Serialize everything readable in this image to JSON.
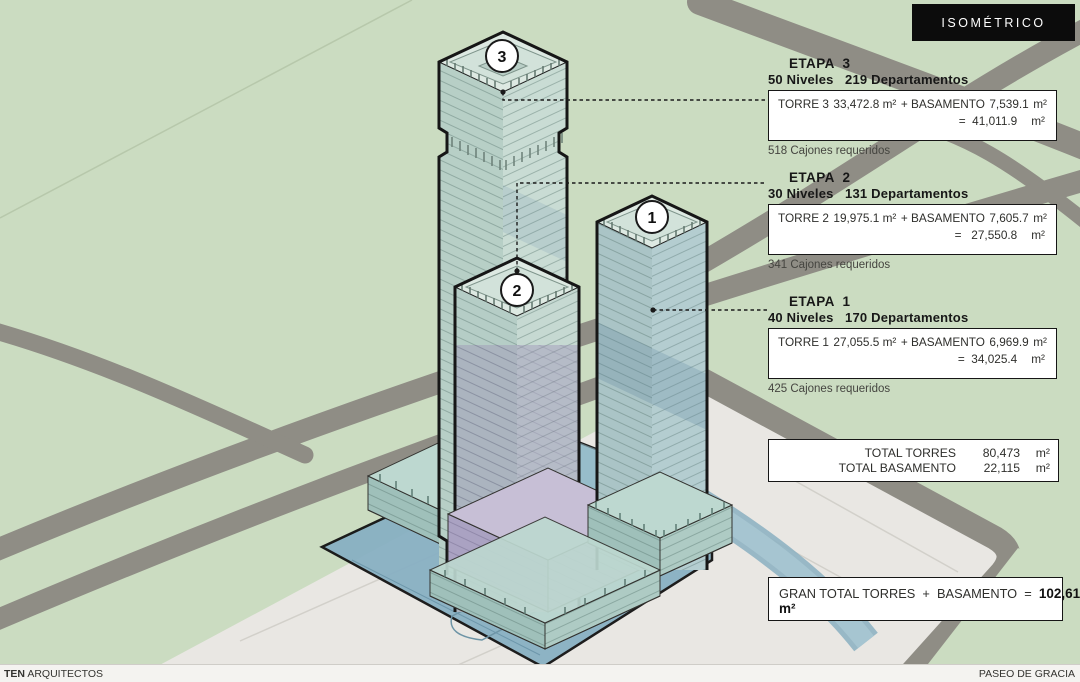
{
  "header": {
    "title": "ISOMÉTRICO"
  },
  "stages": [
    {
      "title": "ETAPA  3",
      "subtitle": "50 Niveles   219 Departamentos",
      "torre": "TORRE 3",
      "torre_area": "33,472.8 m²",
      "plus": "+ BASAMENTO",
      "bas_area": "7,539.1",
      "bas_unit": "m²",
      "total": "=  41,011.9",
      "total_unit": "m²",
      "note": "518 Cajones requeridos",
      "marker": "3"
    },
    {
      "title": "ETAPA  2",
      "subtitle": "30 Niveles   131 Departamentos",
      "torre": "TORRE 2",
      "torre_area": "19,975.1 m²",
      "plus": "+ BASAMENTO",
      "bas_area": "7,605.7",
      "bas_unit": "m²",
      "total": "=   27,550.8",
      "total_unit": "m²",
      "note": "341 Cajones requeridos",
      "marker": "2"
    },
    {
      "title": "ETAPA  1",
      "subtitle": "40 Niveles   170 Departamentos",
      "torre": "TORRE 1",
      "torre_area": "27,055.5 m²",
      "plus": "+ BASAMENTO",
      "bas_area": "6,969.9",
      "bas_unit": "m²",
      "total": "=  34,025.4",
      "total_unit": "m²",
      "note": "425 Cajones requeridos",
      "marker": "1"
    }
  ],
  "totals": {
    "rows": [
      {
        "label": "TOTAL TORRES",
        "value": "80,473",
        "unit": "m²"
      },
      {
        "label": "TOTAL BASAMENTO",
        "value": "22,115",
        "unit": "m²"
      }
    ]
  },
  "grand_total": {
    "label": "GRAN TOTAL TORRES  +  BASAMENTO  =  ",
    "value": "102,618 m²"
  },
  "markers": {
    "tower1": "1",
    "tower2": "2",
    "tower3": "3"
  },
  "credits": {
    "firm_bold": "TEN",
    "firm_rest": " ARQUITECTOS",
    "project": "PASEO DE GRACIA"
  },
  "colors": {
    "background_green": "#cbdcc1",
    "road_gray": "#8f8d85",
    "plaza": "#e9e7e3",
    "deck_blue": "#88b0c3",
    "tower_teal": "#b7cfc6",
    "tower_purple": "#b0a9c6",
    "tag_black": "#0c0c0c"
  }
}
